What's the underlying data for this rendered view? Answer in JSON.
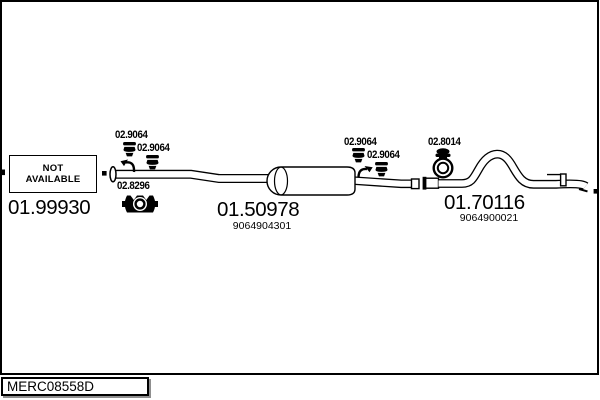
{
  "diagram": {
    "placeholder": {
      "line1": "NOT",
      "line2": "AVAILABLE"
    },
    "parts": [
      {
        "position": "front",
        "number": "01.99930"
      },
      {
        "position": "middle-silencer",
        "number": "01.50978",
        "oem": "9064904301"
      },
      {
        "position": "rear-tailpipe",
        "number": "01.70116",
        "oem": "9064900021"
      }
    ],
    "fittings": [
      {
        "label": "02.9064",
        "type": "rubber-hanger"
      },
      {
        "label": "02.9064",
        "type": "rubber-hanger"
      },
      {
        "label": "02.8296",
        "type": "pipe-clamp"
      },
      {
        "label": "02.9064",
        "type": "rubber-hanger"
      },
      {
        "label": "02.9064",
        "type": "rubber-hanger"
      },
      {
        "label": "02.8014",
        "type": "ring-clamp"
      }
    ]
  },
  "footer": {
    "drawing_code": "MERC08558D"
  },
  "colors": {
    "line": "#000000",
    "background": "#ffffff",
    "shadow": "#8f8f8f"
  }
}
